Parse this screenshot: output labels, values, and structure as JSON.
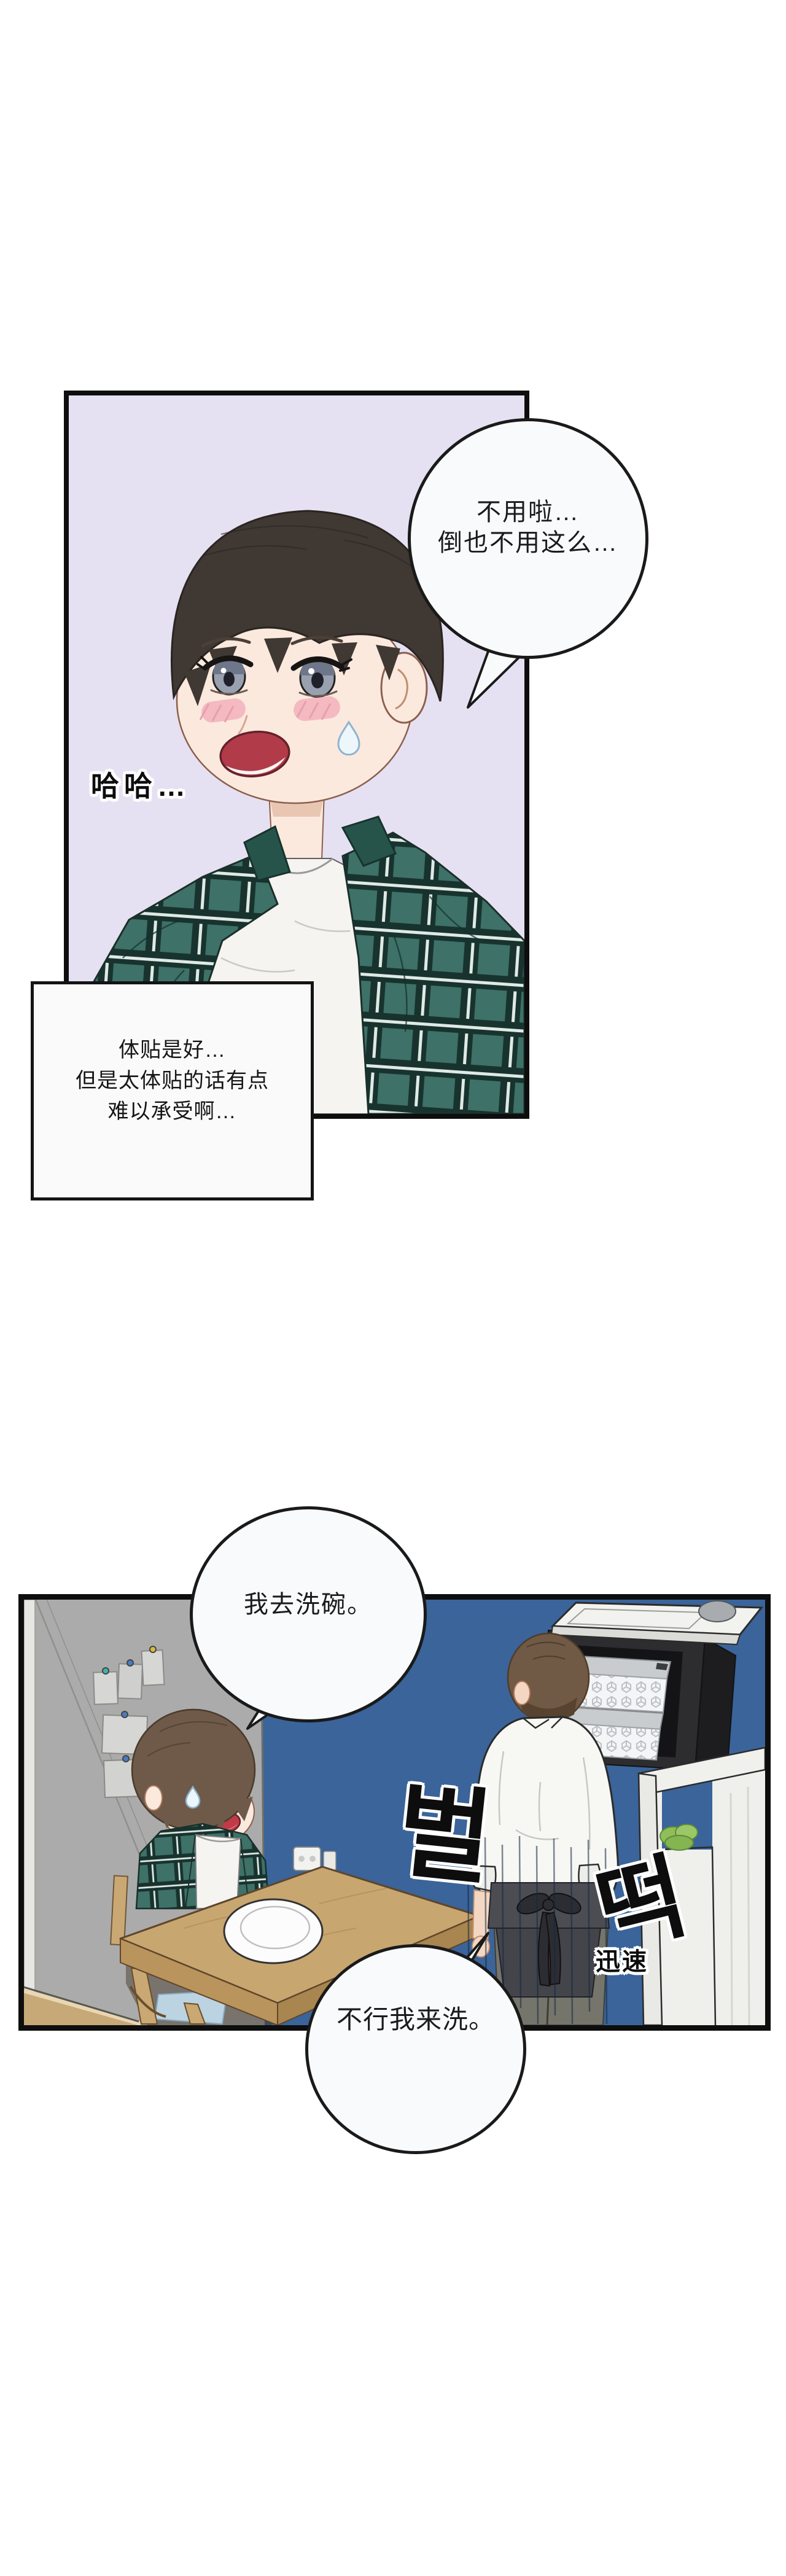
{
  "page": {
    "type": "webtoon comic page",
    "background": "#ffffff"
  },
  "panel1": {
    "background": "#E6E1F2",
    "scene": "blushing young man with dark hair, green plaid shirt over white tee, sweat drop, laughing nervously",
    "speech_bubble": {
      "line1": "不用啦…",
      "line2": "倒也不用这么…"
    },
    "laugh_sfx": "哈哈…",
    "caption": {
      "line1": "体贴是好…",
      "line2": "但是太体贴的话有点",
      "line3": "难以承受啊…"
    }
  },
  "panel2": {
    "background_blue_wall": "#3A649A",
    "background_gray_wall": "#ABABAB",
    "scene": "kitchen: man in plaid sits at wooden table with empty plate; man in white shirt and charcoal apron springs up by black shelf with patterned boxes, white appliance and lettuce cubby",
    "bubble_standing_man": "我去洗碗。",
    "bubble_sitting_man": "不行我来洗。",
    "sfx_korean_top": "벌",
    "sfx_korean_bottom": "떡",
    "sfx_chinese": "迅速"
  },
  "colors": {
    "plaid_green": "#3E7168",
    "plaid_dark": "#18332E",
    "plaid_white": "#DFE9E5",
    "wood_table": "#C8A670",
    "apron_charcoal": "#4C4C53",
    "cushion_blue": "#BCD3E2",
    "skin": "#FBE9DE",
    "hair_black_brown": "#3F3833",
    "hair_brown": "#6F5A49",
    "bubble_fill": "#F9FAFC",
    "panel_border": "#0e0e0e"
  }
}
